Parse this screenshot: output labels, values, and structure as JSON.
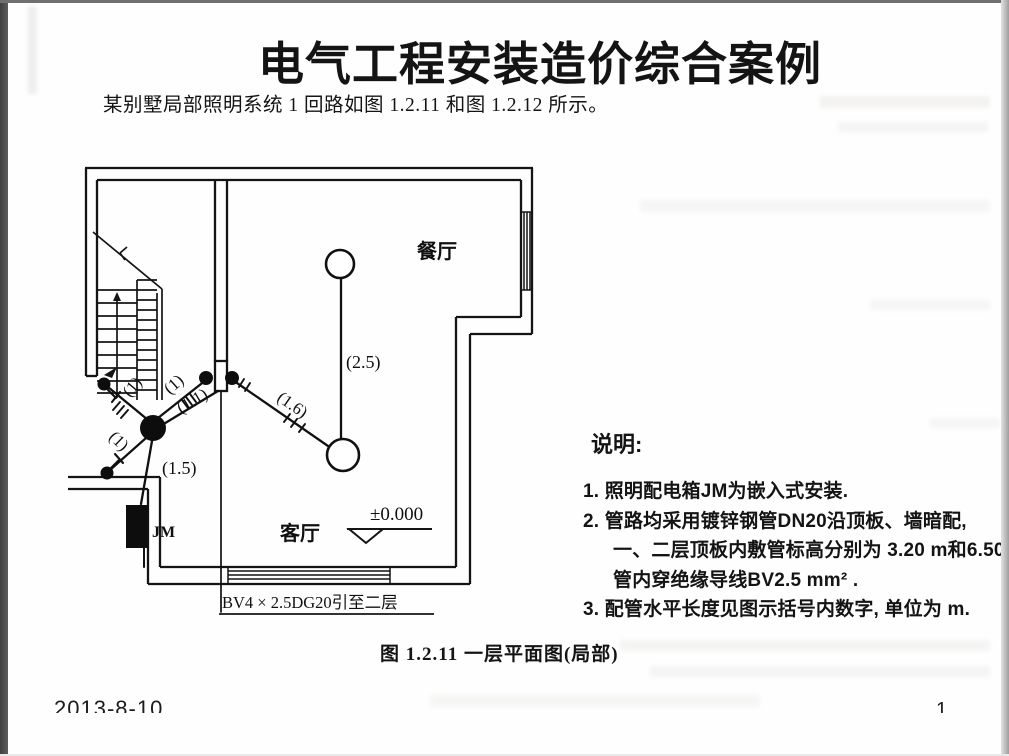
{
  "slide": {
    "title": "电气工程安装造价综合案例",
    "intro": "某别墅局部照明系统 1 回路如图 1.2.11 和图 1.2.12 所示。",
    "caption": "图 1.2.11  一层平面图(局部)",
    "footer_date": "2013-8-10",
    "page_number": "1"
  },
  "plan": {
    "room_dining": "餐厅",
    "room_living": "客厅",
    "panel_label": "JM",
    "elevation": "±0.000",
    "riser_note": "BV4 × 2.5DG20引至二层",
    "seg_2_5": "(2.5)",
    "seg_1_6": "(1.6)",
    "seg_1_1": "(1.1)",
    "seg_1_5": "(1.5)",
    "seg_1_up_left": "(1)",
    "seg_1_up_right": "(1)",
    "seg_1_down_left": "(1)"
  },
  "notes": {
    "heading": "说明:",
    "lines": [
      "1. 照明配电箱JM为嵌入式安装.",
      "2. 管路均采用镀锌钢管DN20沿顶板、墙暗配,",
      "一、二层顶板内敷管标高分别为 3.20 m和6.50 m,",
      "管内穿绝缘导线BV2.5 mm²  .",
      "3. 配管水平长度见图示括号内数字, 单位为 m."
    ]
  }
}
